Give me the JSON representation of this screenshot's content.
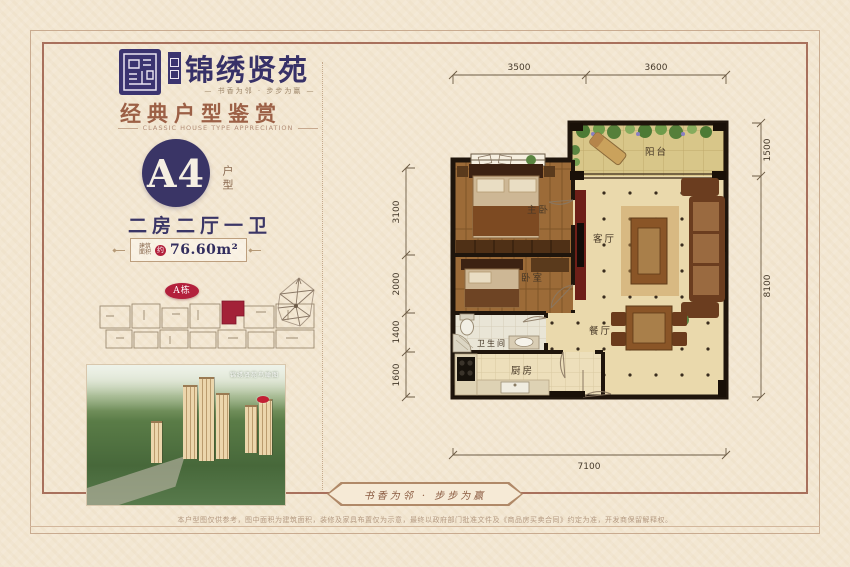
{
  "brand": {
    "name": "锦绣贤苑",
    "tagline": "— 书香为邻 · 步步为赢 —"
  },
  "section": {
    "title": "经典户型鉴赏",
    "subtitle_en": "CLASSIC HOUSE TYPE APPRECIATION"
  },
  "unit": {
    "code": "A4",
    "code_suffix": "户型",
    "layout": "二房二厅一卫",
    "area_label_line1": "建筑",
    "area_label_line2": "面积",
    "area_approx": "约",
    "area_value": "76.60m²"
  },
  "siteplan": {
    "building_badge": "A栋"
  },
  "aerial": {
    "caption": "锦绣贤苑鸟瞰图"
  },
  "floorplan": {
    "rooms": [
      "阳台",
      "主卧",
      "客厅",
      "卧室",
      "卫生间",
      "餐厅",
      "厨房"
    ],
    "dims_top": [
      "3500",
      "3600"
    ],
    "dims_left": [
      "3100",
      "2000",
      "1400",
      "1600"
    ],
    "dims_right": [
      "1500",
      "8100"
    ],
    "dim_bottom": "7100"
  },
  "footer": {
    "slogan": "书香为邻 · 步步为赢",
    "disclaimer": "本户型图仅供参考，图中面积为建筑面积，装修及家具布置仅为示意，最终以政府部门批准文件及《商品房买卖合同》约定为准，开发商保留解释权。"
  },
  "colors": {
    "navy": "#3a3566",
    "brown_title": "#9c6046",
    "badge_red": "#b3203c",
    "cream_bg": "#f3e7d2"
  }
}
